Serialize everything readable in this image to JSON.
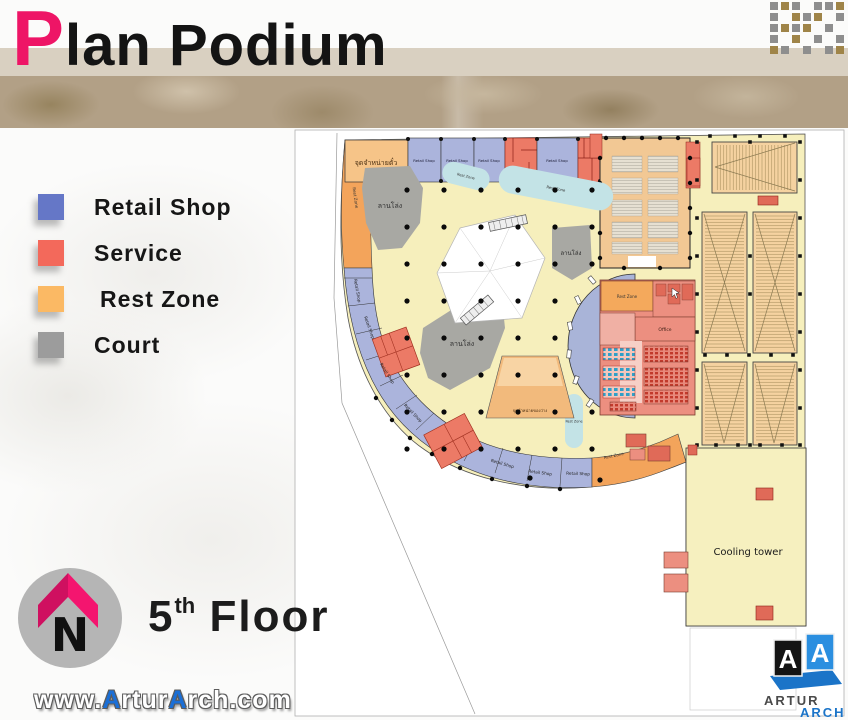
{
  "header": {
    "title_initial": "P",
    "title_rest": "lan Podium"
  },
  "legend": {
    "items": [
      {
        "label": "Retail Shop",
        "color": "#6577c7"
      },
      {
        "label": "Service",
        "color": "#f3695b"
      },
      {
        "label": "Rest Zone",
        "color": "#fbb964"
      },
      {
        "label": "Court",
        "color": "#9c9c9c"
      }
    ]
  },
  "compass": {
    "letter": "N"
  },
  "floor": {
    "number": "5",
    "ordinal": "th",
    "word": "Floor"
  },
  "watermark": {
    "part1": "www.",
    "part2": "A",
    "part3": "rtur",
    "part4": "A",
    "part5": "rch.com"
  },
  "logo": {
    "left_letter": "A",
    "right_letter": "A",
    "name_top": "ARTUR",
    "name_bottom": "ARCH"
  },
  "plan": {
    "labels": {
      "ticket": "จุดจำหน่ายตั๋ว",
      "open_court": "ลานโล่ง",
      "retail": "Retail Shop",
      "rest": "Rest Zone",
      "office": "Office",
      "snack": "จุดจำหน่ายของว่าง",
      "cooling": "Cooling tower"
    },
    "colors": {
      "concourse": "#f6efbc",
      "retail": "#abb4dc",
      "service": "#ec7a66",
      "rest_band": "#f3a45b",
      "theater": "#f5d2a0",
      "court": "#a8a8a3",
      "pool": "#c3e3e6",
      "core_crescent": "#a9b4d8"
    }
  }
}
